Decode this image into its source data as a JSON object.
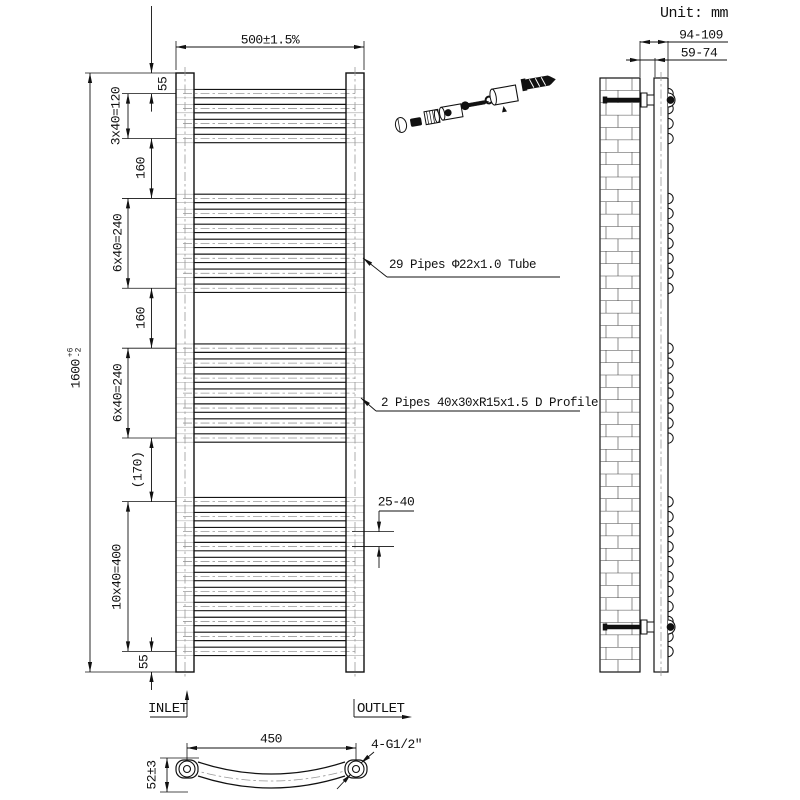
{
  "unit_label": "Unit: mm",
  "front_view": {
    "width_dim": "500±1.5%",
    "height_dim": {
      "value": "1600",
      "tol_plus": "+6",
      "tol_minus": "-2"
    },
    "left_dims": [
      "55",
      "3x40=120",
      "160",
      "6x40=240",
      "160",
      "6x40=240",
      "(170)",
      "10x40=400",
      "55"
    ],
    "gap_dim": "25-40",
    "pipes_label": "29 Pipes Φ22x1.0 Tube",
    "profile_label": "2 Pipes 40x30xR15x1.5 D Profile",
    "inlet_label": "INLET",
    "outlet_label": "OUTLET",
    "pipe_structure": {
      "start_mm": 55,
      "pitch_mm": 40,
      "counts": [
        4,
        7,
        7,
        11
      ],
      "gaps_mm": [
        160,
        160,
        170
      ],
      "total_mm": 1600,
      "total_pipes": 29
    }
  },
  "side_view": {
    "wall_to_face_dim": "94-109",
    "wall_to_inner_dim": "59-74"
  },
  "bottom_view": {
    "centers_dim": "450",
    "connection_label": "4-G1/2″",
    "depth_dim": "52±3"
  }
}
